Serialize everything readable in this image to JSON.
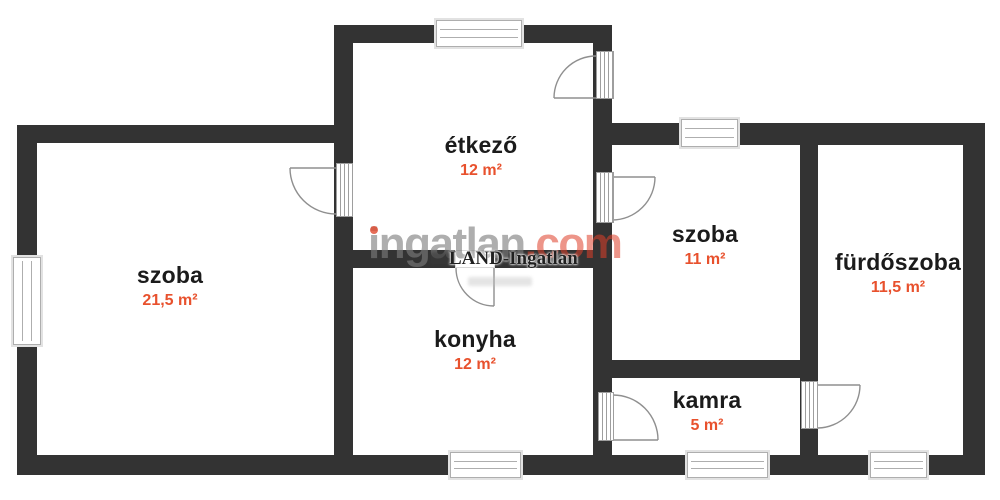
{
  "plan": {
    "watermark": {
      "brand_main": "ingatlan",
      "brand_tld": ".com",
      "agency": "LAND-Ingatlan"
    },
    "rooms": [
      {
        "name": "szoba",
        "area": "21,5 m²"
      },
      {
        "name": "étkező",
        "area": "12 m²"
      },
      {
        "name": "konyha",
        "area": "12 m²"
      },
      {
        "name": "szoba",
        "area": "11 m²"
      },
      {
        "name": "kamra",
        "area": "5 m²"
      },
      {
        "name": "fürdőszoba",
        "area": "11,5 m²"
      }
    ],
    "colors": {
      "wall": "#333333",
      "room_name_text": "#1b1b1b",
      "area_accent": "#e8512d",
      "watermark_gray": "#7d7d7d",
      "watermark_red": "#de3e28"
    }
  }
}
